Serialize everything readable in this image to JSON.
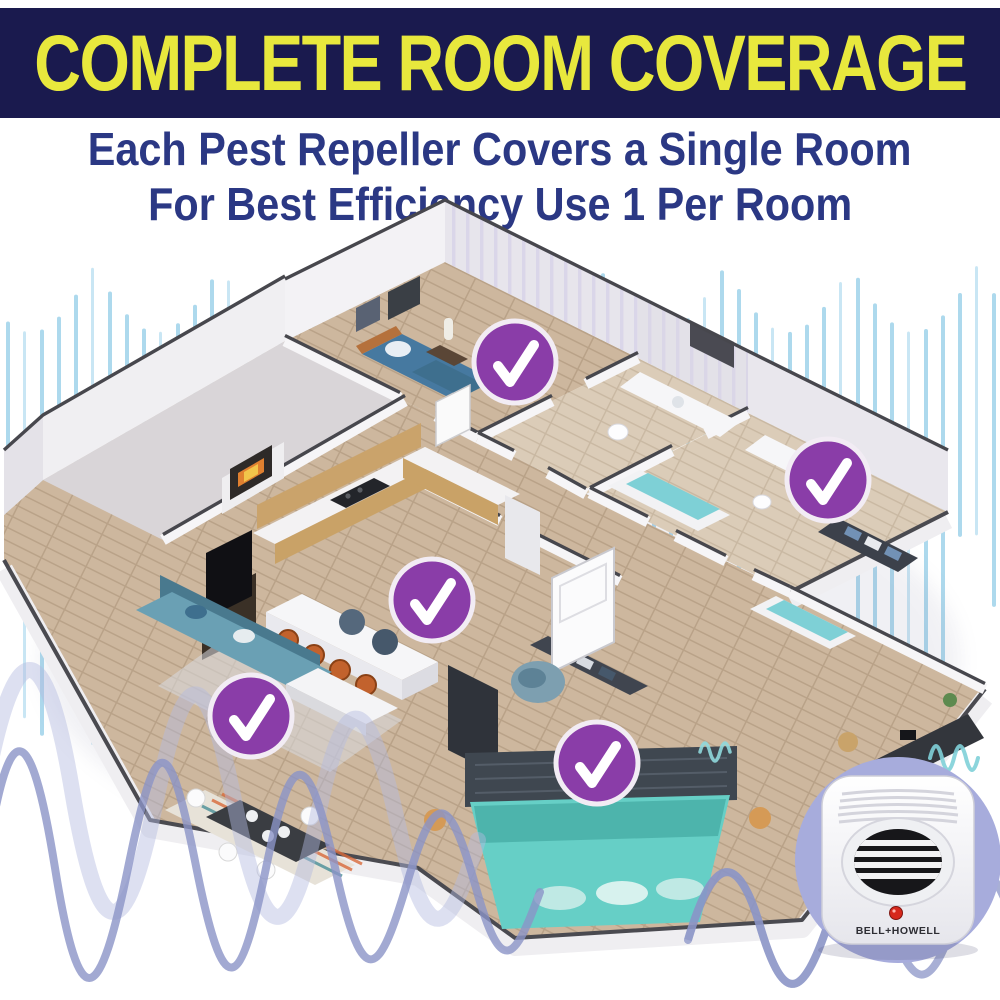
{
  "header": {
    "title": "COMPLETE ROOM COVERAGE"
  },
  "subtitle": {
    "line1": "Each Pest Repeller Covers a Single Room",
    "line2": "For Best Efficiency Use 1 Per Room"
  },
  "floorplan": {
    "type": "isometric-apartment-floor-plan",
    "badge": {
      "symbol": "checkmark",
      "diameter": 86,
      "fill": "#8a3da8",
      "ring": "#f2ecf4",
      "check": "#ffffff"
    },
    "rooms": [
      {
        "name": "top-bedroom",
        "badge": {
          "x": 515,
          "y": 362
        }
      },
      {
        "name": "master-bathroom",
        "badge": {
          "x": 828,
          "y": 480
        }
      },
      {
        "name": "kitchen",
        "badge": {
          "x": 432,
          "y": 600
        }
      },
      {
        "name": "living-room",
        "badge": {
          "x": 251,
          "y": 716
        }
      },
      {
        "name": "bottom-bedroom",
        "badge": {
          "x": 597,
          "y": 763
        }
      }
    ]
  },
  "device": {
    "brand": "BELL+HOWELL",
    "type": "plug-in ultrasonic pest repeller",
    "led_color": "#d6281c",
    "backdrop_color": "#a7acdc"
  },
  "colors": {
    "banner_bg": "#1a1a4e",
    "banner_text": "#e8e83d",
    "subtitle_text": "#2b3884",
    "eq_bar_blue": "#a6d6ec",
    "wave_purple": "#8b94c7",
    "wave_teal": "#7fd0d8",
    "floor_wood": "#cdb79e",
    "badge_purple": "#8a3da8"
  }
}
